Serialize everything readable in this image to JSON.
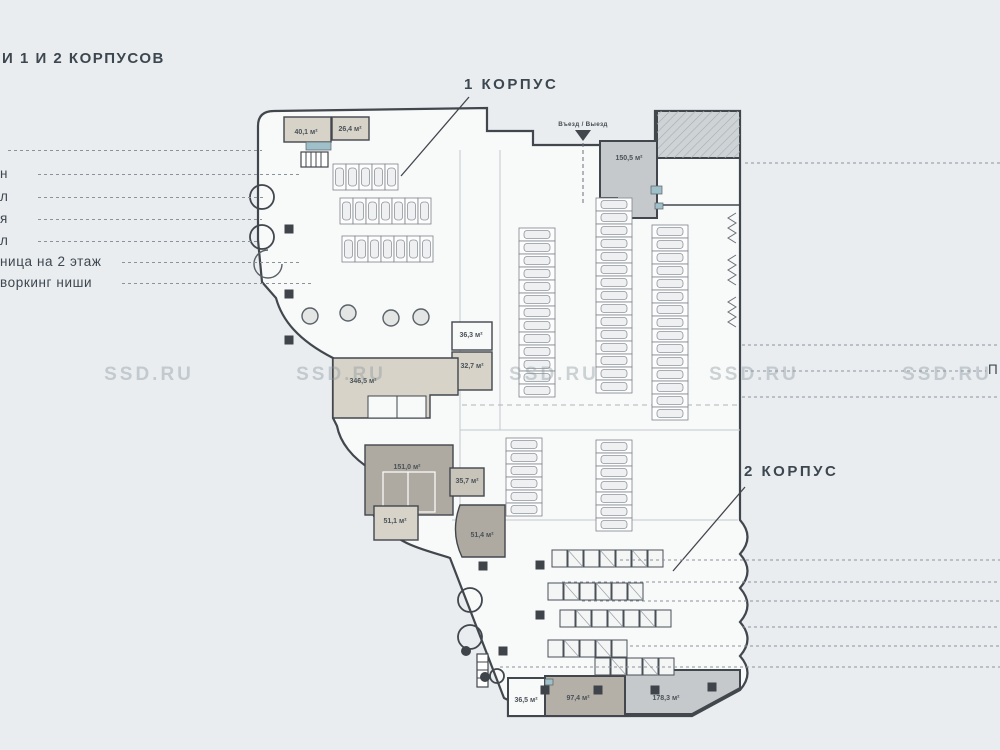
{
  "title": "И 1 И 2 КОРПУСОВ",
  "buildings": {
    "korpus1": "1 КОРПУС",
    "korpus2": "2 КОРПУС"
  },
  "entrance": {
    "label": "Въезд / Выезд"
  },
  "legend_left": {
    "rows": [
      {
        "fragment": ""
      },
      {
        "fragment": "н"
      },
      {
        "fragment": "л"
      },
      {
        "fragment": "я"
      },
      {
        "fragment": "л"
      },
      {
        "fragment": "ница на 2 этаж"
      },
      {
        "fragment": "воркинг ниши"
      }
    ]
  },
  "right_partial_label": "П",
  "rooms": [
    {
      "id": "r40_1",
      "area": "40,1 м²"
    },
    {
      "id": "r26_4",
      "area": "26,4 м²"
    },
    {
      "id": "r150_5",
      "area": "150,5 м²"
    },
    {
      "id": "r36_3",
      "area": "36,3 м²"
    },
    {
      "id": "r32_7",
      "area": "32,7 м²"
    },
    {
      "id": "r346_5",
      "area": "346,5 м²"
    },
    {
      "id": "r151_0",
      "area": "151,0 м²"
    },
    {
      "id": "r35_7",
      "area": "35,7 м²"
    },
    {
      "id": "r51_1",
      "area": "51,1 м²"
    },
    {
      "id": "r51_4",
      "area": "51,4 м²"
    },
    {
      "id": "r36_5",
      "area": "36,5 м²"
    },
    {
      "id": "r97_4",
      "area": "97,4 м²"
    },
    {
      "id": "r178_3",
      "area": "178,3 м²"
    }
  ],
  "watermark": {
    "text": "SSD.RU",
    "count": 5
  },
  "colors": {
    "background": "#e9edf0",
    "floor": "#f8f9f9",
    "walls": "#42474d",
    "room_tan_light": "#d7d3c9",
    "room_tan_mid": "#c9c4ba",
    "room_tan_dark": "#aeaaa1",
    "room_gray": "#c6c9cb",
    "sanitary_teal": "#9fc0c9",
    "callout_dash": "#8b929a",
    "text": "#3d4750",
    "watermark": "#8c98a0"
  }
}
